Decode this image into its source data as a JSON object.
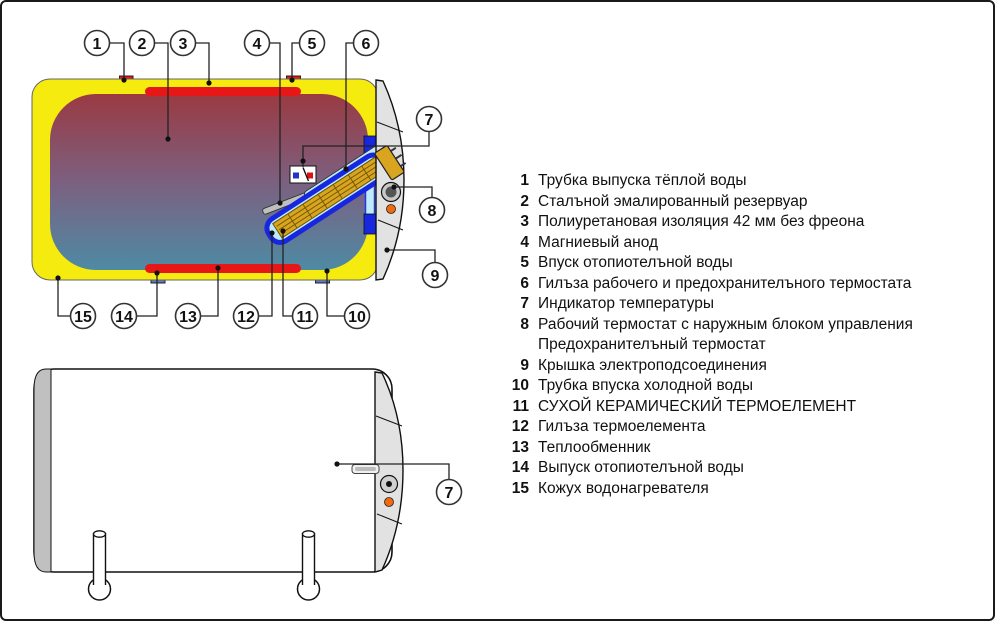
{
  "colors": {
    "insulation_yellow": "#F5EB0F",
    "tank_top": "#9A3A42",
    "tank_mid": "#7C6080",
    "tank_bottom": "#4E8AA4",
    "exchanger_red": "#E81717",
    "pipe_blue": "#5578D2",
    "sleeve_blue": "#1726DF",
    "sleeve_cyan": "#BEEBFA",
    "element_gold": "#D9A41F",
    "cover_gray": "#E2E2E2",
    "led_orange": "#F2680D",
    "anode_gray": "#BFBFBF"
  },
  "legend": {
    "items": [
      {
        "num": "1",
        "lines": [
          "Трубка выпуска тёплой воды"
        ]
      },
      {
        "num": "2",
        "lines": [
          "Сталъной эмалированный резервуар"
        ]
      },
      {
        "num": "3",
        "lines": [
          "Полиуретановая изоляция 42 мм без фреона"
        ]
      },
      {
        "num": "4",
        "lines": [
          "Магниевый анод"
        ]
      },
      {
        "num": "5",
        "lines": [
          "Впуск отопиотелъной воды"
        ]
      },
      {
        "num": "6",
        "lines": [
          "Гилъза рабочего и предохранителъного термостата"
        ]
      },
      {
        "num": "7",
        "lines": [
          "Индикатор температуры"
        ]
      },
      {
        "num": "8",
        "lines": [
          "Рабочий термостат с наружным блоком управления",
          "Предохранителъный термостат"
        ]
      },
      {
        "num": "9",
        "lines": [
          "Крышка электроподсоединения"
        ]
      },
      {
        "num": "10",
        "lines": [
          "Трубка впуска холодной воды"
        ]
      },
      {
        "num": "11",
        "lines": [
          "СУХОЙ КЕРАМИЧЕСКИЙ ТЕРМОЕЛЕМЕНТ"
        ]
      },
      {
        "num": "12",
        "lines": [
          "Гилъза термоелемента"
        ]
      },
      {
        "num": "13",
        "lines": [
          "Теплообменник"
        ]
      },
      {
        "num": "14",
        "lines": [
          "Выпуск отопиотелъной воды"
        ]
      },
      {
        "num": "15",
        "lines": [
          "Кожух водонагревателя"
        ]
      }
    ]
  },
  "diagrams": {
    "top": {
      "name": "cross-section-view",
      "callouts": [
        {
          "num": "1",
          "c": [
            95,
            41
          ],
          "p": "107,41 122,41 122,78",
          "d": [
            122,
            78
          ]
        },
        {
          "num": "2",
          "c": [
            140,
            41
          ],
          "p": "152,41 166,41 166,137",
          "d": [
            166,
            137
          ]
        },
        {
          "num": "3",
          "c": [
            181,
            41
          ],
          "p": "193,41 207,41 207,81",
          "d": [
            207,
            81
          ]
        },
        {
          "num": "4",
          "c": [
            255,
            41
          ],
          "p": "267,41 278,41 278,201",
          "d": [
            278,
            201
          ]
        },
        {
          "num": "5",
          "c": [
            310,
            41
          ],
          "p": "298,41 290,41 290,78",
          "d": [
            290,
            78
          ]
        },
        {
          "num": "6",
          "c": [
            364,
            41
          ],
          "p": "352,41 344,41 344,167",
          "d": [
            344,
            167
          ]
        },
        {
          "num": "7",
          "c": [
            427,
            117
          ],
          "p": "427,129 427,144 301,144 301,165",
          "d": [
            301,
            159
          ]
        },
        {
          "num": "8",
          "c": [
            430,
            208
          ],
          "p": "392,185 430,185 430,196",
          "d": [
            392,
            185
          ]
        },
        {
          "num": "9",
          "c": [
            433,
            273
          ],
          "p": "385,248 433,248 433,261",
          "d": [
            385,
            248
          ]
        },
        {
          "num": "10",
          "c": [
            355,
            314
          ],
          "p": "343,314 325,314 325,269",
          "d": [
            325,
            269
          ]
        },
        {
          "num": "11",
          "c": [
            303,
            314
          ],
          "p": "291,314 281,314 281,229",
          "d": [
            281,
            229
          ]
        },
        {
          "num": "12",
          "c": [
            244,
            314
          ],
          "p": "256,314 270,314 270,231",
          "d": [
            270,
            231
          ]
        },
        {
          "num": "13",
          "c": [
            186,
            314
          ],
          "p": "198,314 216,314 216,266",
          "d": [
            216,
            266
          ]
        },
        {
          "num": "14",
          "c": [
            122,
            314
          ],
          "p": "134,314 155,314 155,271",
          "d": [
            155,
            271
          ]
        },
        {
          "num": "15",
          "c": [
            81,
            314
          ],
          "p": "69,314 56,314 56,276",
          "d": [
            56,
            276
          ]
        }
      ]
    },
    "bottom": {
      "name": "exterior-view",
      "callouts": [
        {
          "num": "7",
          "c": [
            447,
            490
          ],
          "p": "447,478 447,462 335,462",
          "d": [
            335,
            462
          ]
        }
      ]
    }
  }
}
